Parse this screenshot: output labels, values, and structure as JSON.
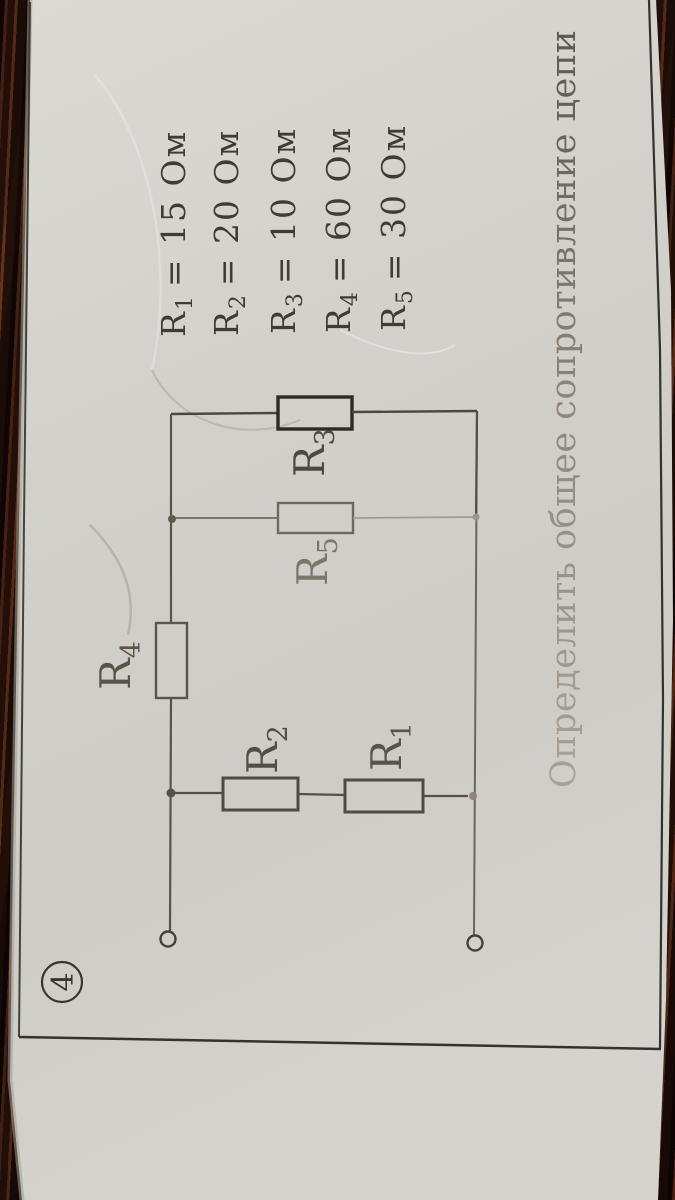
{
  "problem_number": "4",
  "task_text": "Определить общее сопротивление цепи",
  "given_values": [
    {
      "name": "R",
      "sub": "1",
      "value": "= 15 Ом"
    },
    {
      "name": "R",
      "sub": "2",
      "value": "= 20 Ом"
    },
    {
      "name": "R",
      "sub": "3",
      "value": "= 10 Ом"
    },
    {
      "name": "R",
      "sub": "4",
      "value": "= 60 Ом"
    },
    {
      "name": "R",
      "sub": "5",
      "value": "= 30 Ом"
    }
  ],
  "circuit": {
    "labels": {
      "r1": {
        "name": "R",
        "sub": "1"
      },
      "r2": {
        "name": "R",
        "sub": "2"
      },
      "r3": {
        "name": "R",
        "sub": "3"
      },
      "r4": {
        "name": "R",
        "sub": "4"
      },
      "r5": {
        "name": "R",
        "sub": "5"
      }
    }
  },
  "colors": {
    "paper": "#d4d2cc",
    "ink": "#3f3b34",
    "wood": "#2b150c"
  }
}
